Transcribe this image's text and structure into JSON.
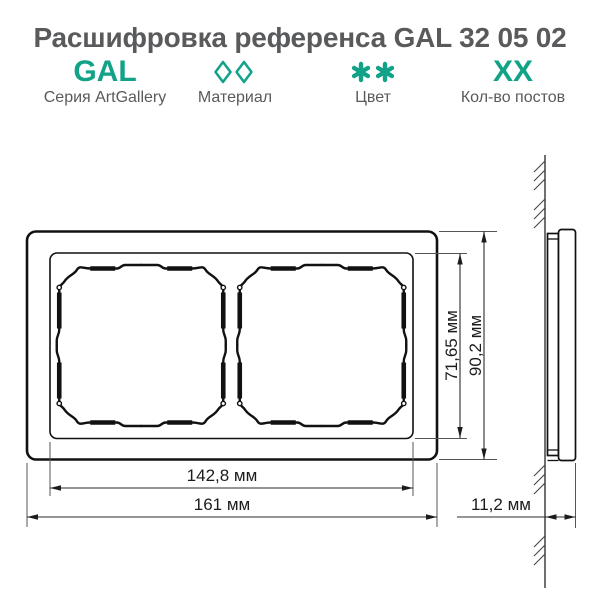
{
  "header": {
    "title": "Расшифровка референса GAL 32 05 02",
    "codes": [
      {
        "code": "GAL",
        "label": "Серия ArtGallery"
      },
      {
        "code": "◊◊",
        "label": "Материал"
      },
      {
        "code": "**",
        "label": "Цвет"
      },
      {
        "code": "XX",
        "label": "Кол-во постов"
      }
    ]
  },
  "colors": {
    "accent": "#12a287",
    "text": "#595a5c",
    "line": "#111111"
  },
  "drawing": {
    "type": "technical-drawing",
    "apertures_count": 2,
    "dimensions": {
      "inner_height": "71,65 мм",
      "outer_height": "90,2 мм",
      "inner_width": "142,8 мм",
      "outer_width": "161 мм",
      "depth": "11,2 мм"
    }
  }
}
